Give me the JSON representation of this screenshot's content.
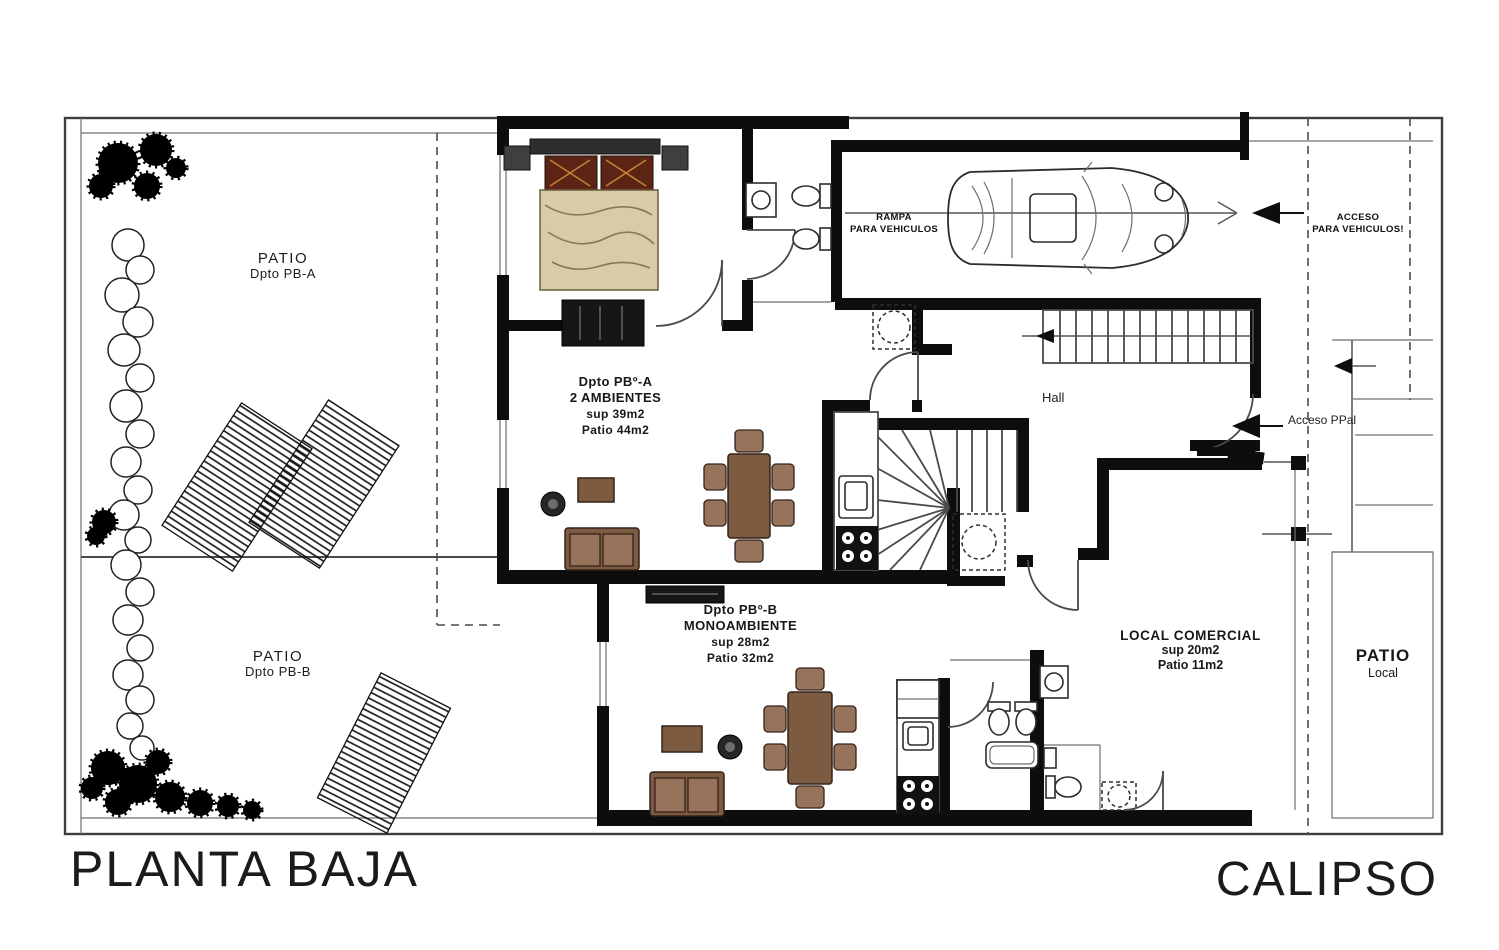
{
  "plan": {
    "title_left": "PLANTA BAJA",
    "title_right": "CALIPSO",
    "labels": {
      "patio_a": {
        "line1": "PATIO",
        "line2": "Dpto PB-A"
      },
      "patio_b": {
        "line1": "PATIO",
        "line2": "Dpto PB-B"
      },
      "patio_local": {
        "line1": "PATIO",
        "line2": "Local"
      },
      "dpto_a": {
        "name": "Dpto PBº-A",
        "rooms": "2 AMBIENTES",
        "area": "sup 39m2",
        "patio": "Patio 44m2"
      },
      "dpto_b": {
        "name": "Dpto PBº-B",
        "rooms": "MONOAMBIENTE",
        "area": "sup 28m2",
        "patio": "Patio 32m2"
      },
      "local": {
        "name": "LOCAL COMERCIAL",
        "area": "sup 20m2",
        "patio": "Patio 11m2"
      },
      "hall": "Hall",
      "ramp": {
        "line1": "RAMPA",
        "line2": "PARA VEHICULOS"
      },
      "vehicle_access": {
        "line1": "ACCESO",
        "line2": "PARA VEHICULOS!"
      },
      "main_access": "Acceso PPal"
    },
    "colors": {
      "wall": "#0d0d0d",
      "furniture": "#7d5b40",
      "furniture_light": "#96735a",
      "bed_blanket": "#d8cba8",
      "pillow": "#5c2414",
      "line": "#3a3a3a"
    }
  }
}
